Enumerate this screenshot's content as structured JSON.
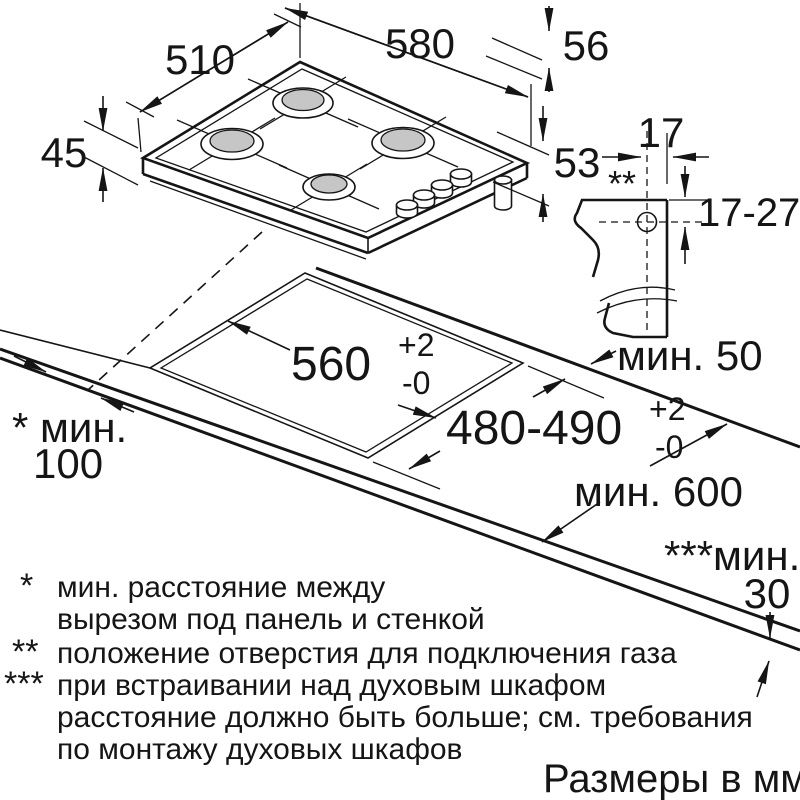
{
  "units_note": "Размеры в мм",
  "dimensions": {
    "hob_depth": "510",
    "hob_width": "580",
    "height_with_grate": "56",
    "height_with_connection": "53",
    "body_height": "45",
    "gas_hole_offset": "17",
    "gas_hole_range": "17-27",
    "gas_hole_marker": "**",
    "min_rear": "мин. 50",
    "min_side_label": "* мин.",
    "min_side_value": "100",
    "cutout_width": "560",
    "cutout_width_tol_plus": "+2",
    "cutout_width_tol_minus": "-0",
    "cutout_depth": "480-490",
    "cutout_depth_tol_plus": "+2",
    "cutout_depth_tol_minus": "-0",
    "min_worktop_depth": "мин. 600",
    "min_below_label": "***мин.",
    "min_below_value": "30"
  },
  "footnotes": [
    {
      "marker": "*",
      "lines": [
        "мин. расстояние между",
        "вырезом под панель и стенкой"
      ]
    },
    {
      "marker": "**",
      "lines": [
        "положение отверстия для подключения газа"
      ]
    },
    {
      "marker": "***",
      "lines": [
        "при встраивании над духовым шкафом",
        "расстояние должно быть больше; см. требования",
        "по монтажу духовых шкафов"
      ]
    }
  ],
  "colors": {
    "line": "#151515",
    "burner_cap": "#c6c6c6",
    "background": "#ffffff"
  }
}
